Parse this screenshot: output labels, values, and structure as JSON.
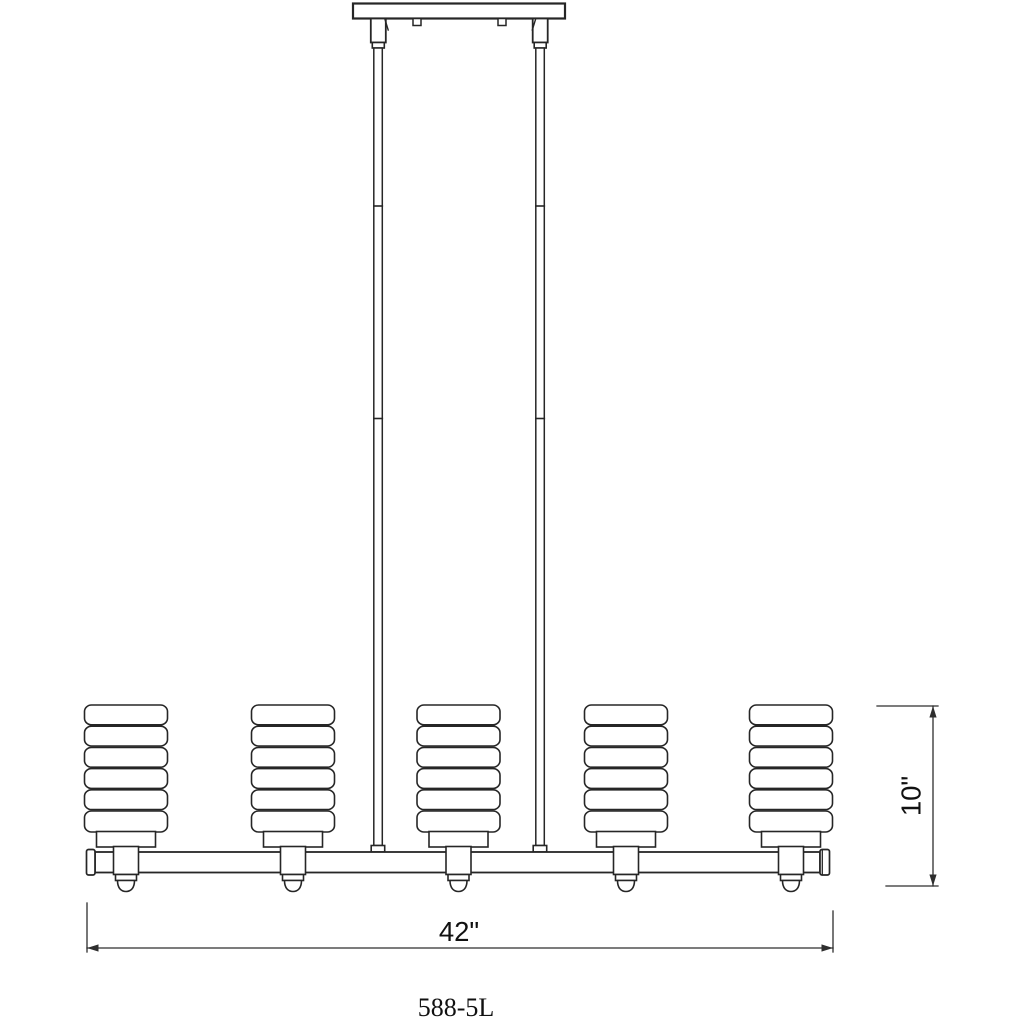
{
  "colors": {
    "background": "#ffffff",
    "line": "#262626",
    "dimension_line": "#2e2e2e",
    "text": "#111111"
  },
  "drawing": {
    "kind": "line-art installation diagram",
    "fixture": {
      "model_number": "588-5L",
      "light_count": 5,
      "shade_style": "ribbed-cylinder",
      "suspension_rods": 2
    },
    "dimensions": {
      "overall_width": "42\"",
      "shade_height": "10\""
    }
  }
}
